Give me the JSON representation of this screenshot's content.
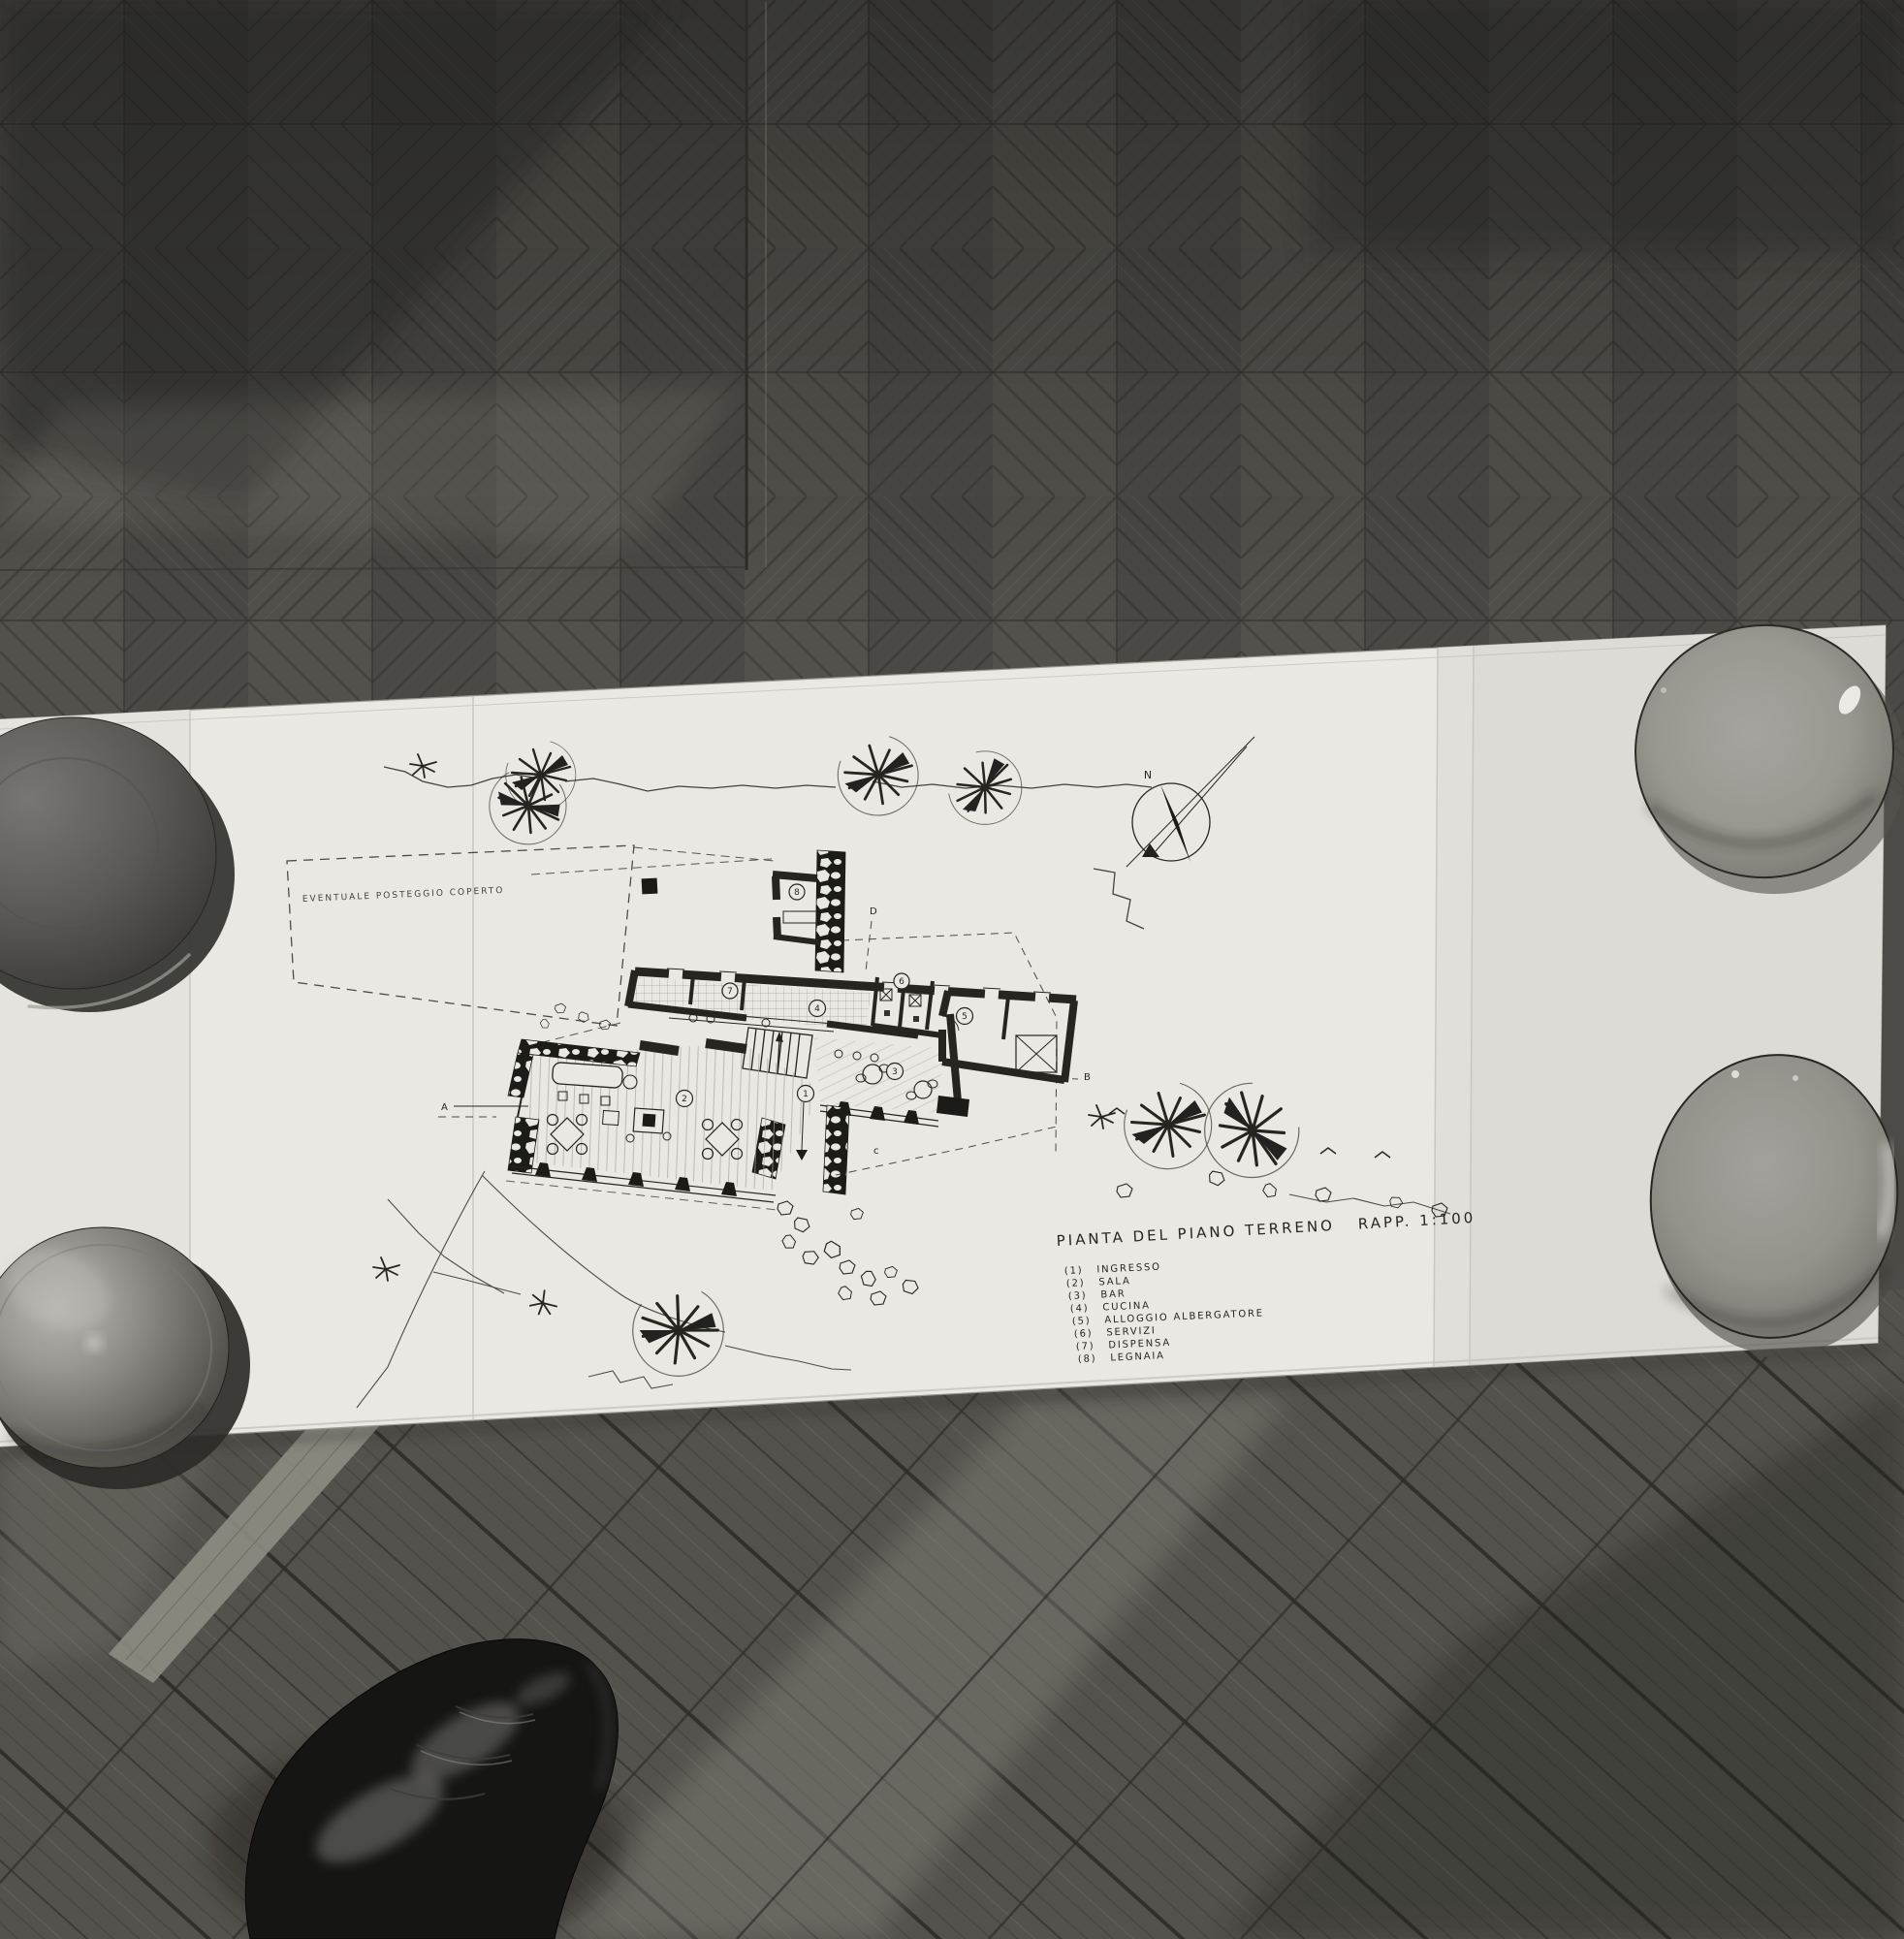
{
  "drawing": {
    "title": "PIANTA DEL PIANO TERRENO",
    "scale": "RAPP. 1:100",
    "site_note": "EVENTUALE POSTEGGIO COPERTO",
    "compass": {
      "north_label": "N"
    },
    "section_markers": {
      "a": "A",
      "b": "B",
      "c": "c",
      "d": "D"
    },
    "rooms": [
      {
        "id": "1",
        "legend_num": "(1)",
        "label": "INGRESSO"
      },
      {
        "id": "2",
        "legend_num": "(2)",
        "label": "SALA"
      },
      {
        "id": "3",
        "legend_num": "(3)",
        "label": "BAR"
      },
      {
        "id": "4",
        "legend_num": "(4)",
        "label": "CUCINA"
      },
      {
        "id": "5",
        "legend_num": "(5)",
        "label": "ALLOGGIO ALBERGATORE"
      },
      {
        "id": "6",
        "legend_num": "(6)",
        "label": "SERVIZI"
      },
      {
        "id": "7",
        "legend_num": "(7)",
        "label": "DISPENSA"
      },
      {
        "id": "8",
        "legend_num": "(8)",
        "label": "LEGNAIA"
      }
    ]
  }
}
